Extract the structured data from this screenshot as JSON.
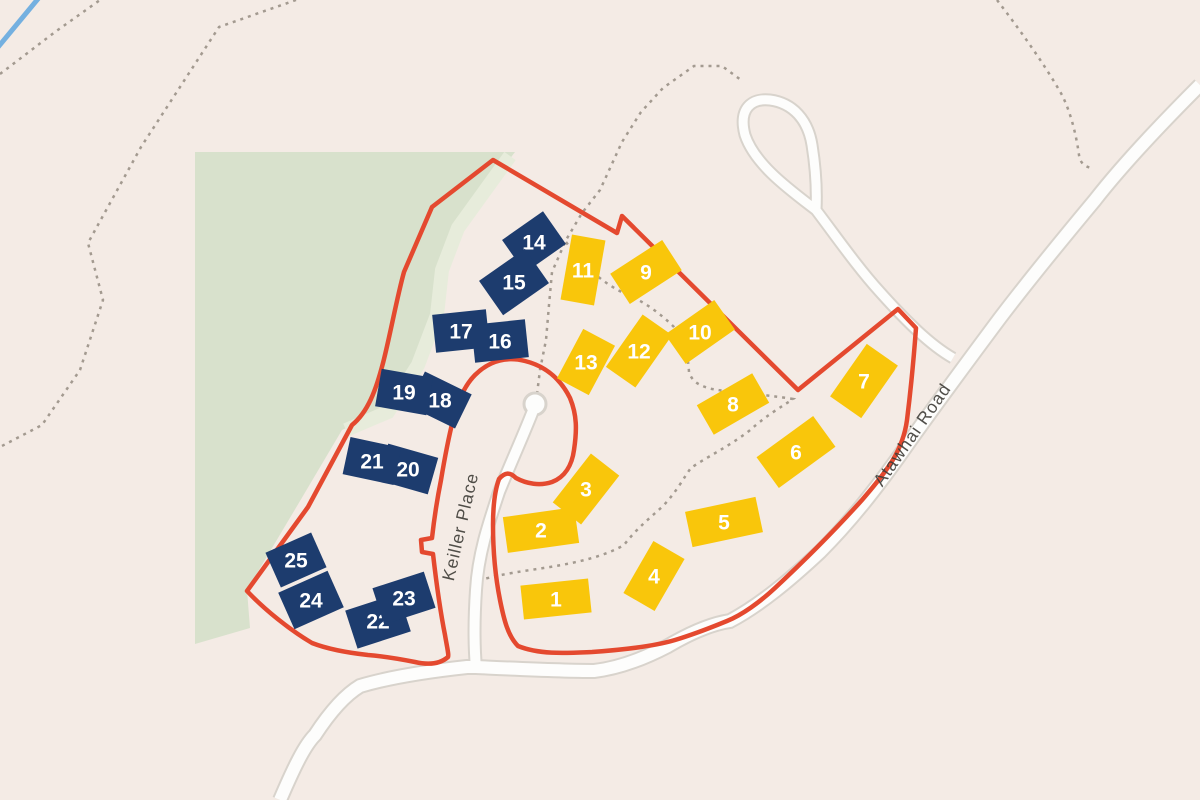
{
  "map": {
    "colors": {
      "background": "#f4ebe5",
      "greenspace": "#d8e1cc",
      "greenspace_band": "#e7ecdb",
      "boundary": "#e4492f",
      "road_fill": "#fdfdfc",
      "road_casing": "#d8d3cc",
      "footpath": "#a39a90",
      "stream": "#74b0e0",
      "yellow_building": "#f9c60b",
      "navy_building": "#1d3c6e",
      "number_text": "#ffffff",
      "street_label": "#3e3c37"
    }
  },
  "roads": {
    "keiller": {
      "label": "Keiller Place"
    },
    "atawhai": {
      "label": "Atawhai Road"
    }
  },
  "buildings": {
    "yellow": [
      {
        "n": "1",
        "x": 556,
        "y": 599,
        "w": 68,
        "h": 34,
        "a": -6
      },
      {
        "n": "2",
        "x": 541,
        "y": 530,
        "w": 72,
        "h": 36,
        "a": -8
      },
      {
        "n": "3",
        "x": 586,
        "y": 489,
        "w": 62,
        "h": 36,
        "a": -52
      },
      {
        "n": "4",
        "x": 654,
        "y": 576,
        "w": 60,
        "h": 36,
        "a": -60
      },
      {
        "n": "5",
        "x": 724,
        "y": 522,
        "w": 72,
        "h": 36,
        "a": -12
      },
      {
        "n": "6",
        "x": 796,
        "y": 452,
        "w": 70,
        "h": 38,
        "a": -36
      },
      {
        "n": "7",
        "x": 864,
        "y": 381,
        "w": 64,
        "h": 38,
        "a": -55
      },
      {
        "n": "8",
        "x": 733,
        "y": 404,
        "w": 64,
        "h": 34,
        "a": -30
      },
      {
        "n": "9",
        "x": 646,
        "y": 272,
        "w": 62,
        "h": 36,
        "a": -33
      },
      {
        "n": "10",
        "x": 700,
        "y": 332,
        "w": 60,
        "h": 36,
        "a": -35
      },
      {
        "n": "11",
        "x": 583,
        "y": 270,
        "w": 34,
        "h": 66,
        "a": 10
      },
      {
        "n": "12",
        "x": 639,
        "y": 351,
        "w": 64,
        "h": 36,
        "a": -55
      },
      {
        "n": "13",
        "x": 586,
        "y": 362,
        "w": 56,
        "h": 36,
        "a": -62
      }
    ],
    "navy": [
      {
        "n": "14",
        "x": 534,
        "y": 242,
        "w": 50,
        "h": 40,
        "a": -35
      },
      {
        "n": "15",
        "x": 514,
        "y": 282,
        "w": 56,
        "h": 42,
        "a": -35
      },
      {
        "n": "16",
        "x": 500,
        "y": 341,
        "w": 54,
        "h": 38,
        "a": -6
      },
      {
        "n": "17",
        "x": 461,
        "y": 331,
        "w": 54,
        "h": 38,
        "a": -6
      },
      {
        "n": "18",
        "x": 440,
        "y": 400,
        "w": 52,
        "h": 38,
        "a": 26
      },
      {
        "n": "19",
        "x": 404,
        "y": 392,
        "w": 52,
        "h": 38,
        "a": 10
      },
      {
        "n": "20",
        "x": 408,
        "y": 469,
        "w": 52,
        "h": 38,
        "a": 16
      },
      {
        "n": "21",
        "x": 372,
        "y": 461,
        "w": 52,
        "h": 38,
        "a": 12
      },
      {
        "n": "22",
        "x": 378,
        "y": 621,
        "w": 56,
        "h": 40,
        "a": -18
      },
      {
        "n": "23",
        "x": 404,
        "y": 598,
        "w": 54,
        "h": 38,
        "a": -18
      },
      {
        "n": "24",
        "x": 311,
        "y": 600,
        "w": 54,
        "h": 40,
        "a": -24
      },
      {
        "n": "25",
        "x": 296,
        "y": 560,
        "w": 50,
        "h": 38,
        "a": -24
      }
    ]
  }
}
